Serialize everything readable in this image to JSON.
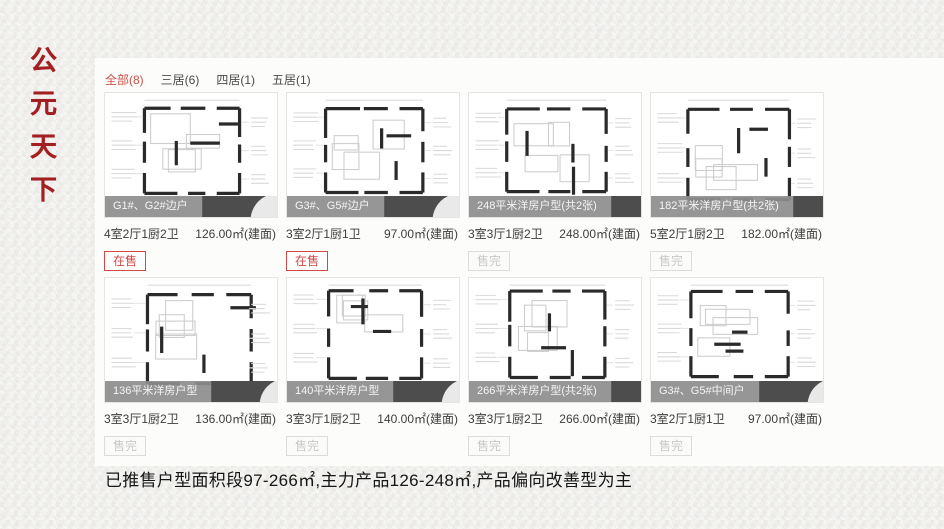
{
  "brand": {
    "title": "公元天下",
    "title_chars": [
      "公",
      "元",
      "天",
      "下"
    ],
    "color": "#a31f22"
  },
  "filter_tabs": [
    {
      "label": "全部(8)",
      "active": true
    },
    {
      "label": "三居(6)",
      "active": false
    },
    {
      "label": "四居(1)",
      "active": false
    },
    {
      "label": "五居(1)",
      "active": false
    }
  ],
  "cards": [
    {
      "title": "G1#、G2#边户",
      "layout": "4室2厅1厨2卫",
      "area": "126.00㎡(建面)",
      "status": "在售",
      "state": "onsale"
    },
    {
      "title": "G3#、G5#边户",
      "layout": "3室2厅1厨1卫",
      "area": "97.00㎡(建面)",
      "status": "在售",
      "state": "onsale"
    },
    {
      "title": "248平米洋房户型(共2张)",
      "layout": "3室3厅1厨2卫",
      "area": "248.00㎡(建面)",
      "status": "售完",
      "state": "soldout"
    },
    {
      "title": "182平米洋房户型(共2张)",
      "layout": "5室2厅1厨2卫",
      "area": "182.00㎡(建面)",
      "status": "售完",
      "state": "soldout"
    },
    {
      "title": "136平米洋房户型",
      "layout": "3室3厅1厨2卫",
      "area": "136.00㎡(建面)",
      "status": "售完",
      "state": "soldout"
    },
    {
      "title": "140平米洋房户型",
      "layout": "3室3厅1厨2卫",
      "area": "140.00㎡(建面)",
      "status": "售完",
      "state": "soldout"
    },
    {
      "title": "266平米洋房户型(共2张)",
      "layout": "3室3厅1厨2卫",
      "area": "266.00㎡(建面)",
      "status": "售完",
      "state": "soldout"
    },
    {
      "title": "G3#、G5#中间户",
      "layout": "3室2厅1厨1卫",
      "area": "97.00㎡(建面)",
      "status": "售完",
      "state": "soldout"
    }
  ],
  "summary": "已推售户型面积段97-266㎡,主力产品126-248㎡,产品偏向改善型为主",
  "icons": {
    "camera": "camera-icon"
  },
  "colors": {
    "accent_red": "#cf4a45",
    "brand_red": "#a31f22",
    "overlay_gray": "#8d8d8d",
    "soldout_gray": "#c9c8c6",
    "paper": "#f0efec"
  }
}
